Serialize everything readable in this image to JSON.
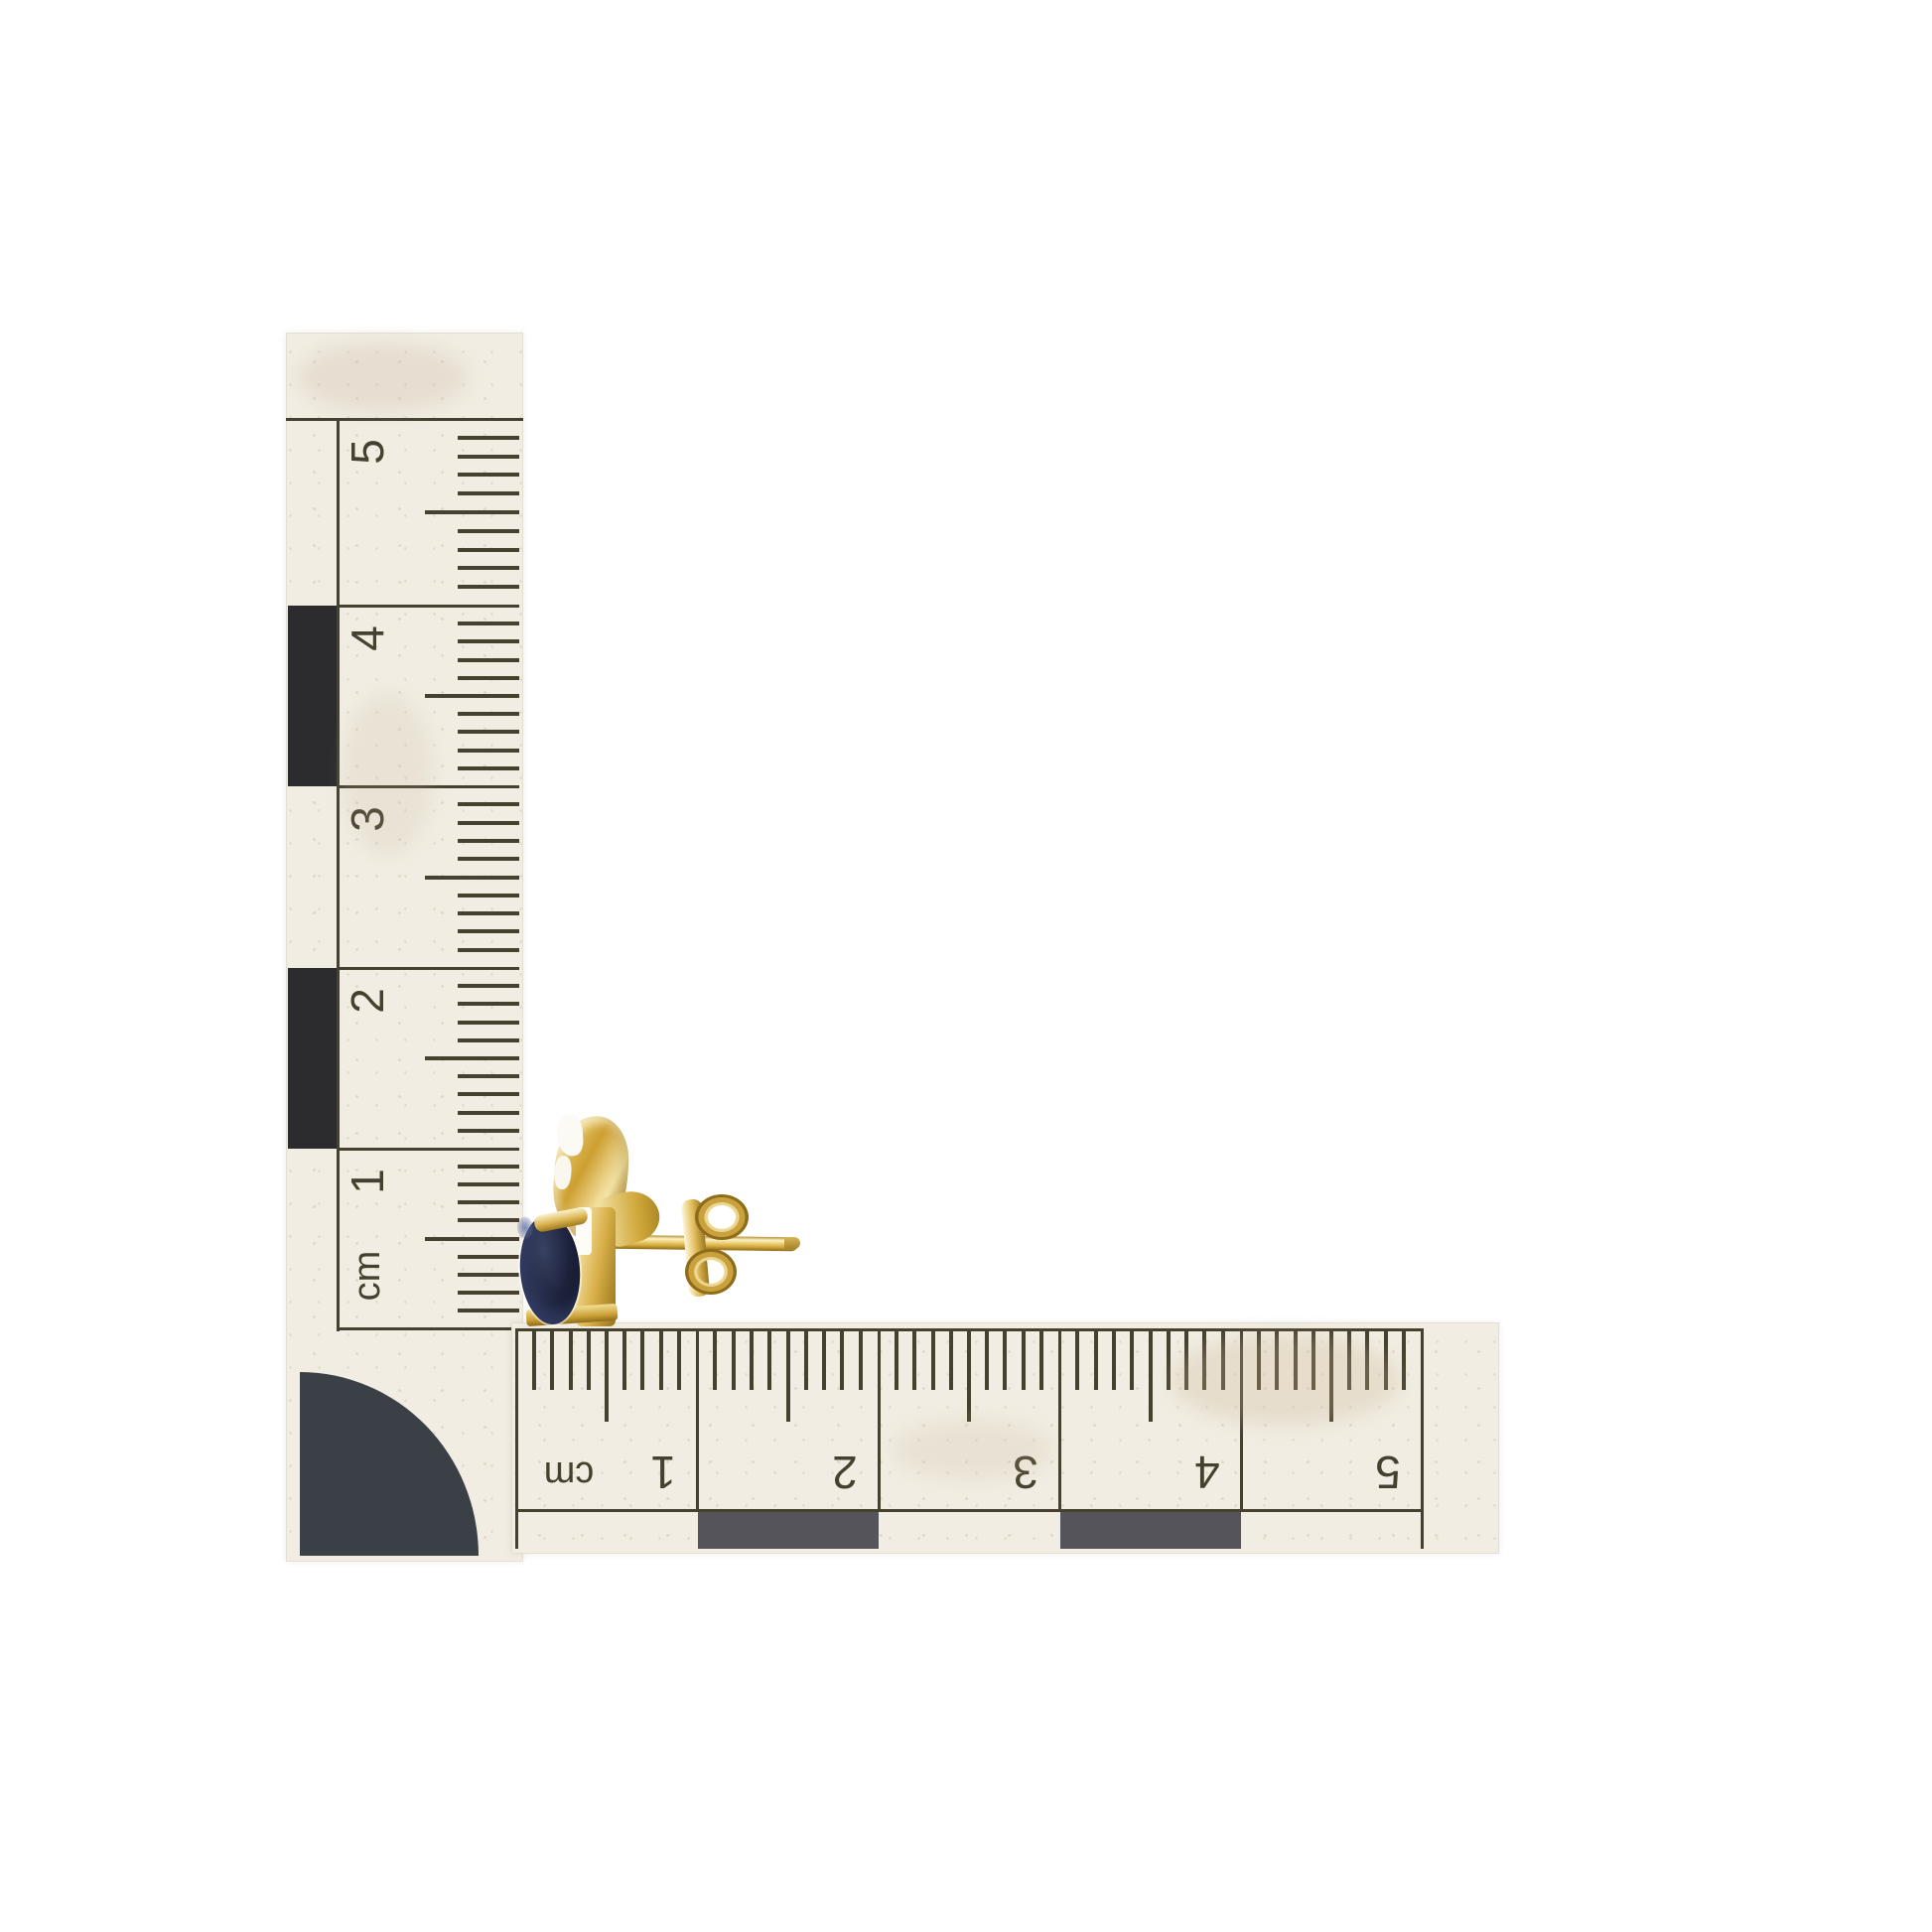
{
  "scale": {
    "vertical_ruler": {
      "unit_label": "cm",
      "labels": [
        "5",
        "4",
        "3",
        "2",
        "1",
        "cm"
      ],
      "ticks_per_cm": 10
    },
    "horizontal_ruler": {
      "unit_label": "cm",
      "labels": [
        "cm",
        "1",
        "2",
        "3",
        "4",
        "5"
      ],
      "ticks_per_cm": 10
    }
  },
  "objects": {
    "earring": {
      "parts": [
        "ornate-gold-setting",
        "oval-gemstone",
        "gold-post",
        "butterfly-back"
      ]
    }
  },
  "colors": {
    "background": "#ffffff",
    "paper": "#f1ede2",
    "ink": "#46412f",
    "checker_black": "#2c2c2e",
    "checker_gray": "#55545a",
    "corner_disc": "#3a4046",
    "gold": "#ddb44c",
    "gold_highlight": "#faf1c6",
    "gold_shadow": "#8f6c19",
    "gemstone_dark": "#0e1124",
    "gemstone_mid": "#242a45",
    "gemstone_glint": "#5a67a0"
  }
}
